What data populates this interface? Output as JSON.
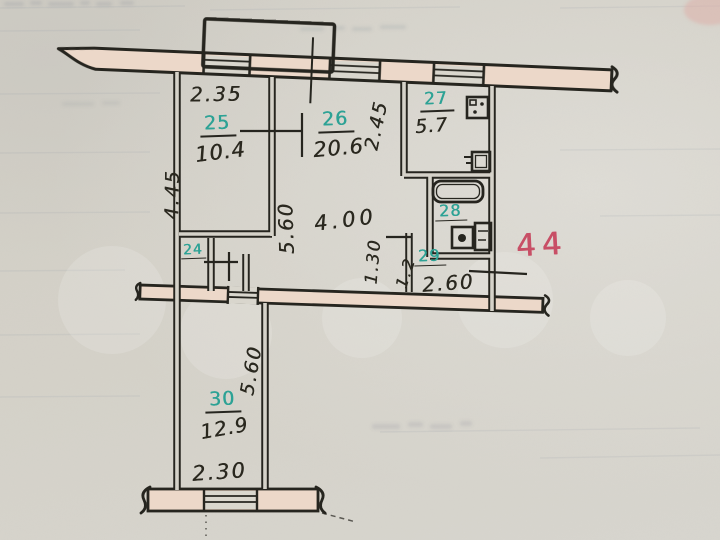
{
  "plan": {
    "red_mark": "44",
    "rooms": {
      "r24": {
        "number": "24"
      },
      "r25": {
        "number": "25",
        "area": "10.4"
      },
      "r26": {
        "number": "26",
        "area": "20.6"
      },
      "r27": {
        "number": "27",
        "area": "5.7"
      },
      "r28": {
        "number": "28"
      },
      "r29": {
        "number": "29",
        "area": "1.2"
      },
      "r30": {
        "number": "30",
        "area": "12.9"
      }
    },
    "dimensions": {
      "room25_width": "2.35",
      "room25_depth": "4.45",
      "room26_depth": "5.60",
      "room26_width": "4.00",
      "room27_depth": "2.45",
      "hall_depth": "1.30",
      "hall_width": "2.60",
      "room30_length": "5.60",
      "room30_width": "2.30"
    },
    "colors": {
      "ink": "#26251f",
      "room_number_teal": "#2da295",
      "red_mark": "#c84f66",
      "wall_fill": "#ecd8c9",
      "paper": "#d4d1c8"
    }
  }
}
